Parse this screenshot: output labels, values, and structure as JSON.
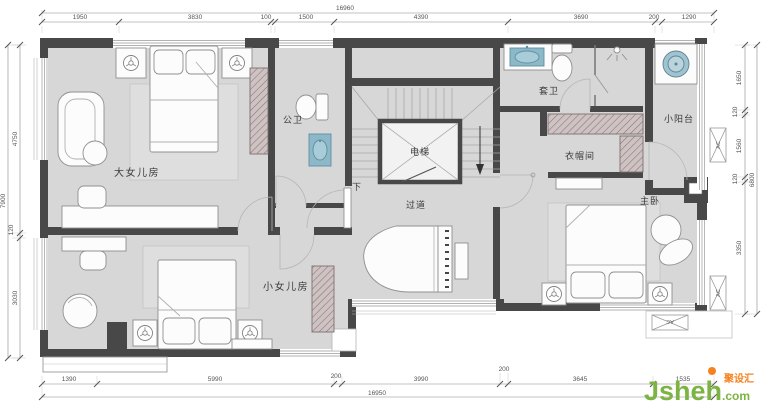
{
  "dims": {
    "top": {
      "overall": "16960",
      "segments": [
        "1950",
        "3830",
        "100",
        "1500",
        "4390",
        "3690",
        "200",
        "1290"
      ]
    },
    "bottom": {
      "overall": "16950",
      "segments": [
        "1390",
        "5990",
        "200",
        "3990",
        "200",
        "3645",
        "1535"
      ]
    },
    "left": {
      "overall": "7900",
      "segments": [
        "4750",
        "120",
        "3030"
      ]
    },
    "right": {
      "overall": "6800",
      "segments": [
        "1650",
        "120",
        "1560",
        "120",
        "3350"
      ]
    }
  },
  "rooms": {
    "big_daughter": "大女儿房",
    "small_daughter": "小女儿房",
    "public_bath": "公卫",
    "ensuite_bath": "套卫",
    "cloakroom": "衣帽间",
    "master": "主卧",
    "balcony": "小阳台",
    "corridor": "过道",
    "elevator": "电梯",
    "stair_down": "下"
  },
  "annotations": {
    "ac": "AC"
  },
  "colors": {
    "wall": "#484848",
    "floor": "#d7d7d7",
    "fixture_blue": "#8db8c8",
    "watermark_green": "#7cb342",
    "watermark_orange": "#f5821f"
  },
  "watermark": {
    "brand": "Jsheh",
    "tld": ".com",
    "cjk": "聚设汇"
  }
}
